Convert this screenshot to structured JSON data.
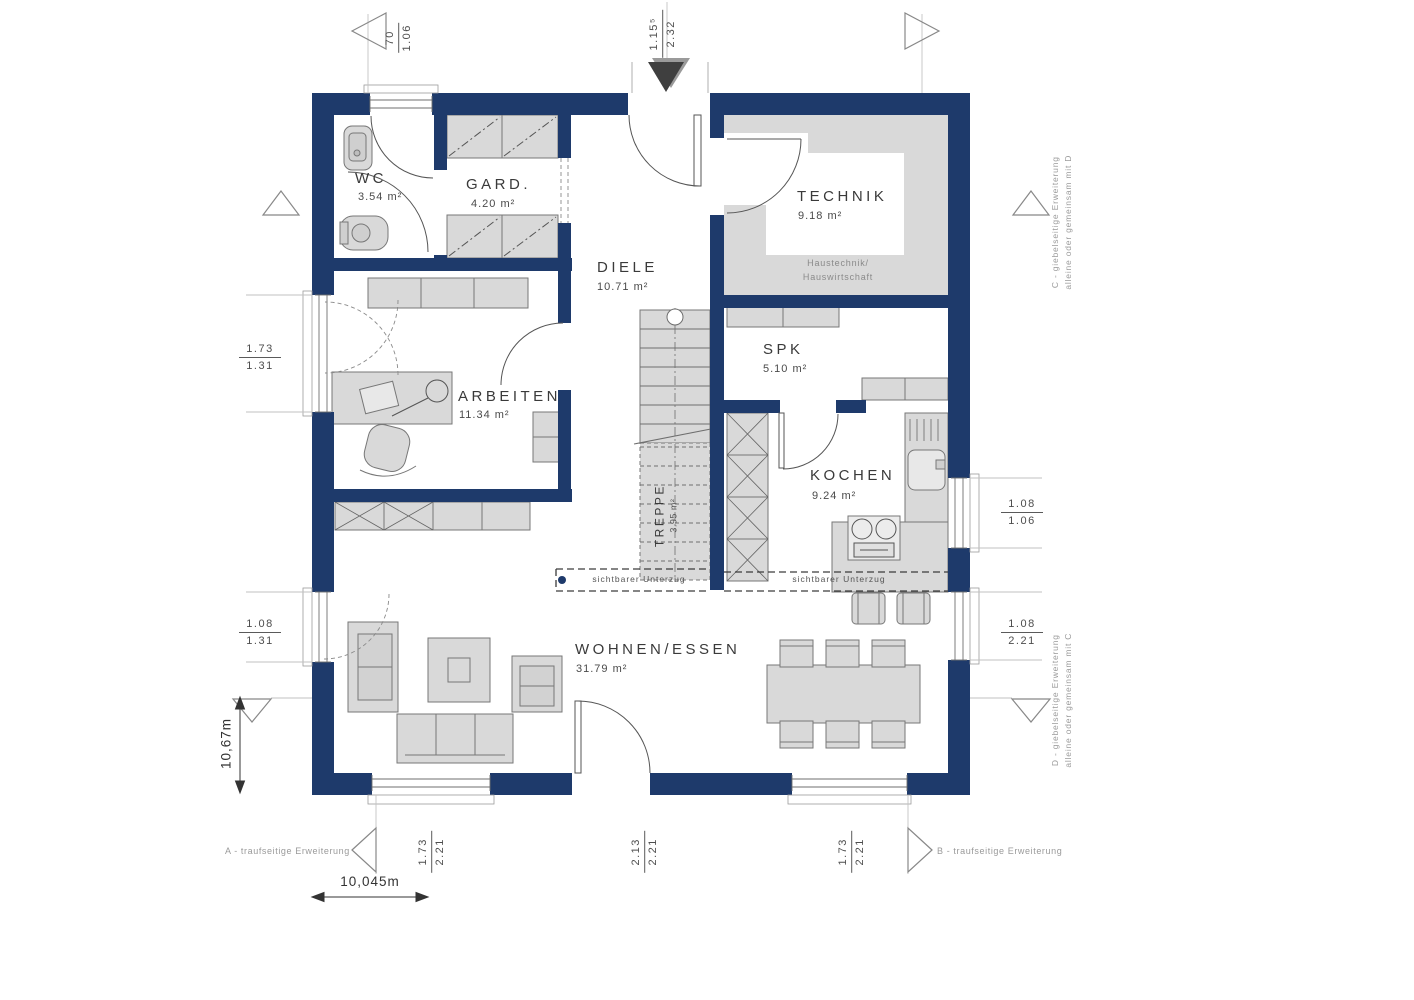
{
  "colors": {
    "wall": "#1e3a6b",
    "furniture": "#d9d9d9",
    "beam_dot": "#1e3a6b"
  },
  "rooms": {
    "wc": {
      "name": "WC",
      "area": "3.54 m²"
    },
    "gard": {
      "name": "GARD.",
      "area": "4.20 m²"
    },
    "diele": {
      "name": "DIELE",
      "area": "10.71 m²"
    },
    "technik": {
      "name": "TECHNIK",
      "area": "9.18 m²",
      "note_line1": "Haustechnik/",
      "note_line2": "Hauswirtschaft"
    },
    "spk": {
      "name": "SPK",
      "area": "5.10 m²"
    },
    "arbeiten": {
      "name": "ARBEITEN",
      "area": "11.34 m²"
    },
    "kochen": {
      "name": "KOCHEN",
      "area": "9.24 m²"
    },
    "treppe": {
      "name": "TREPPE",
      "area": "3.95 m²"
    },
    "wohnen_essen": {
      "name": "WOHNEN/ESSEN",
      "area": "31.79 m²"
    }
  },
  "dimensions": {
    "top_left": {
      "a": "70",
      "b": "1.06"
    },
    "top_center": {
      "a": "1.15⁵",
      "b": "2.32"
    },
    "left_upper": {
      "a": "1.73",
      "b": "1.31"
    },
    "left_lower": {
      "a": "1.08",
      "b": "1.31"
    },
    "right_upper": {
      "a": "1.08",
      "b": "1.06"
    },
    "right_lower": {
      "a": "1.08",
      "b": "2.21"
    },
    "bottom_left": {
      "a": "1.73",
      "b": "2.21"
    },
    "bottom_center": {
      "a": "2.13",
      "b": "2.21"
    },
    "bottom_right": {
      "a": "1.73",
      "b": "2.21"
    },
    "total_width": "10,045m",
    "total_height": "10,67m"
  },
  "annotations": {
    "a": "A - traufseitige Erweiterung",
    "b": "B - traufseitige Erweiterung",
    "c_line1": "C - giebelseitige Erweiterung",
    "c_line2": "alleine oder gemeinsam mit D",
    "d_line1": "D - giebelseitige Erweiterung",
    "d_line2": "alleine oder gemeinsam mit C",
    "beam_left": "sichtbarer Unterzug",
    "beam_right": "sichtbarer Unterzug"
  }
}
